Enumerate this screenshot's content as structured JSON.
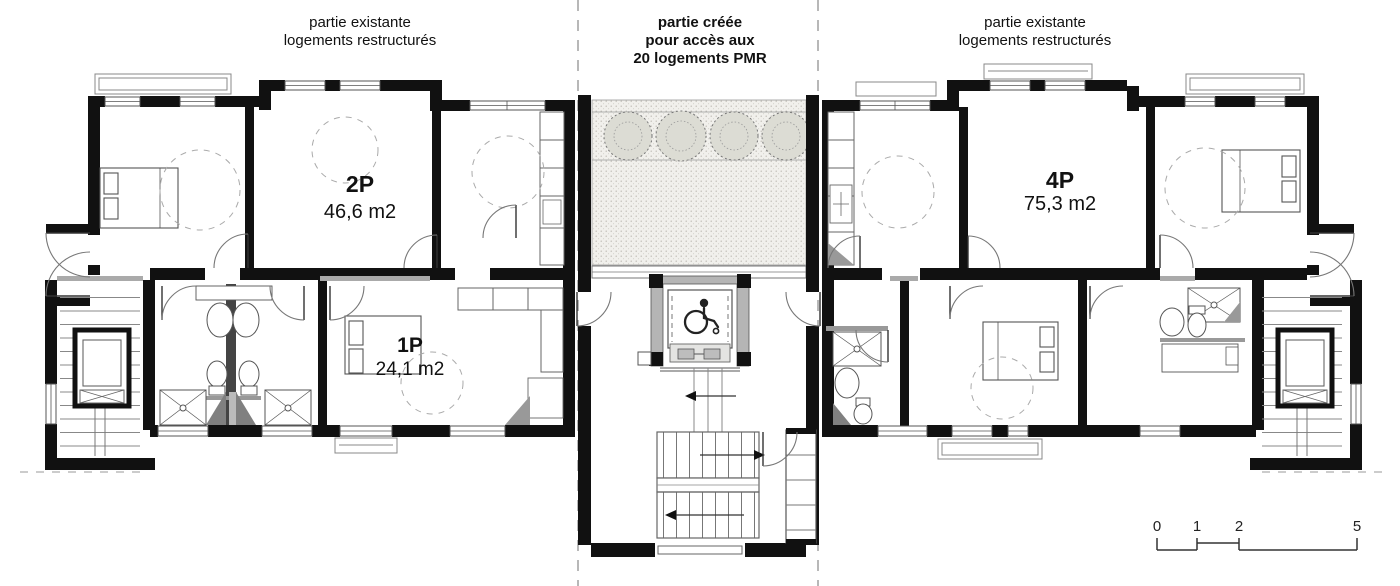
{
  "annotations": {
    "left": {
      "line1": "partie existante",
      "line2": "logements restructurés"
    },
    "center": {
      "line1": "partie créée",
      "line2": "pour accès aux",
      "line3": "20 logements PMR"
    },
    "right": {
      "line1": "partie existante",
      "line2": "logements restructurés"
    }
  },
  "apartments": [
    {
      "label": "2P",
      "area": "46,6 m2"
    },
    {
      "label": "1P",
      "area": "24,1 m2"
    },
    {
      "label": "4P",
      "area": "75,3 m2"
    }
  ],
  "scale_bar": {
    "ticks": [
      "0",
      "1",
      "2",
      "5"
    ]
  },
  "icons": {
    "wheelchair": "wheelchair-pmr-icon",
    "trees": "tree-icon"
  },
  "colors": {
    "wall": "#111111",
    "detail_line": "#666666",
    "light_gray": "#bbbbbb",
    "paving": "#efeeea"
  }
}
